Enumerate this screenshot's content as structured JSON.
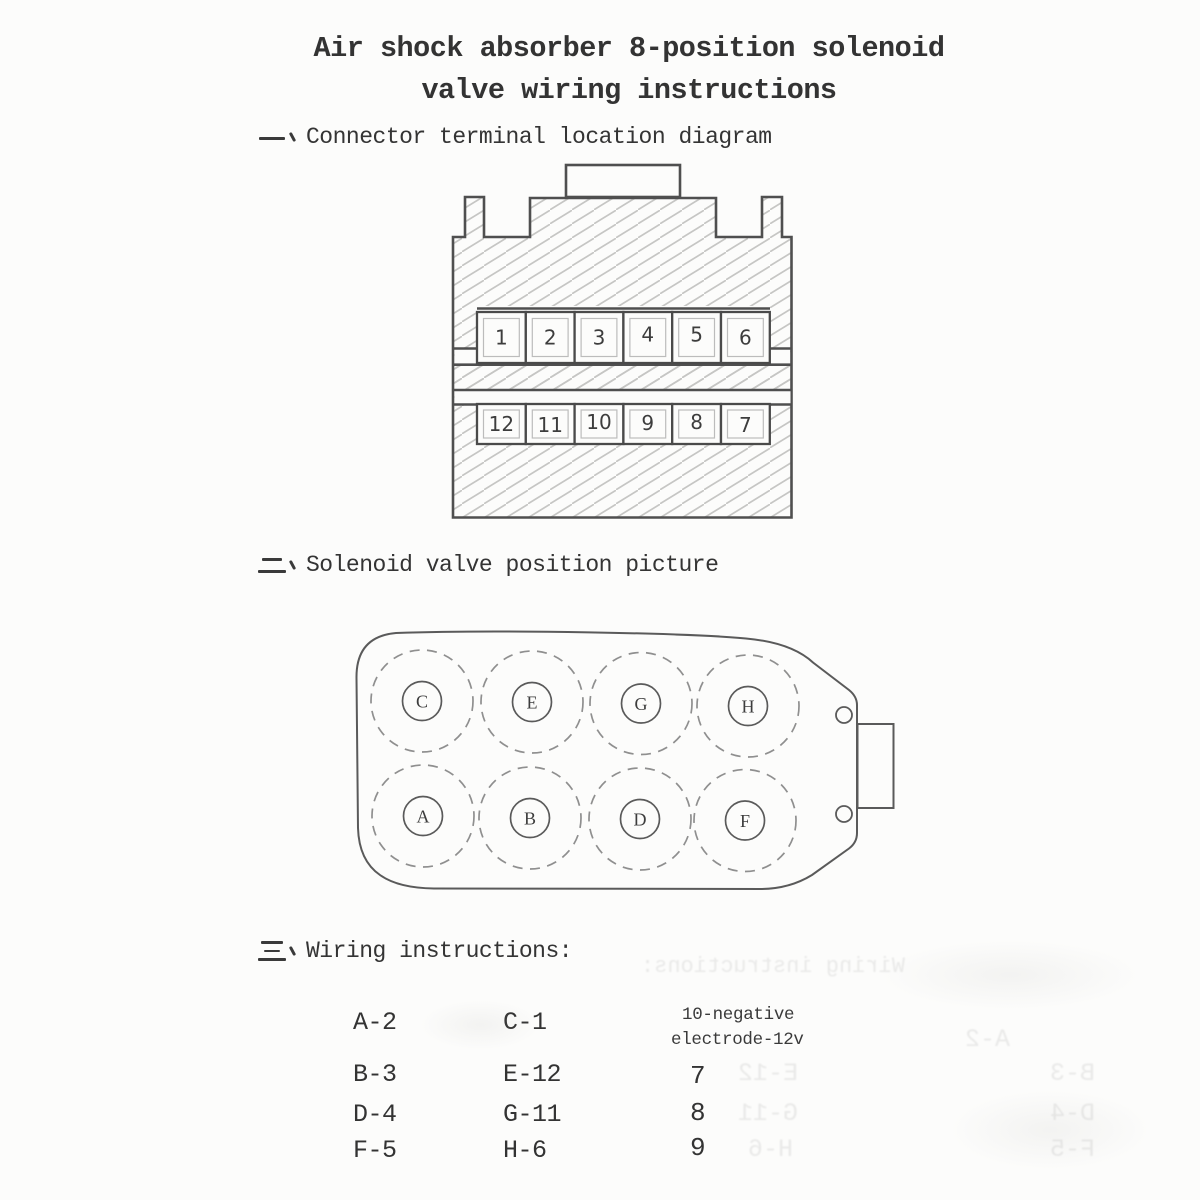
{
  "title": {
    "line1": "Air shock absorber 8-position solenoid",
    "line2": "valve wiring instructions"
  },
  "sections": {
    "one": {
      "marker": "一、",
      "heading": "Connector terminal location diagram"
    },
    "two": {
      "marker": "二、",
      "heading": "Solenoid valve position picture"
    },
    "three": {
      "marker": "三、",
      "heading": "Wiring instructions:"
    }
  },
  "connector": {
    "top_row": [
      "1",
      "2",
      "3",
      "4",
      "5",
      "6"
    ],
    "bottom_row": [
      "12",
      "11",
      "10",
      "9",
      "8",
      "7"
    ]
  },
  "valve": {
    "top_row": [
      "C",
      "E",
      "G",
      "H"
    ],
    "bottom_row": [
      "A",
      "B",
      "D",
      "F"
    ]
  },
  "wiring": {
    "col1": [
      "A-2",
      "B-3",
      "D-4",
      "F-5"
    ],
    "col2": [
      "C-1",
      "E-12",
      "G-11",
      "H-6"
    ],
    "col3_header": {
      "line1": "10-negative",
      "line2": "electrode-12v"
    },
    "col3": [
      "7",
      "8",
      "9"
    ]
  },
  "colors": {
    "ink": "#383838",
    "diagram_outline": "#4f4f4f",
    "hatch": "#c6c6c4",
    "paper": "#fcfcfb"
  }
}
